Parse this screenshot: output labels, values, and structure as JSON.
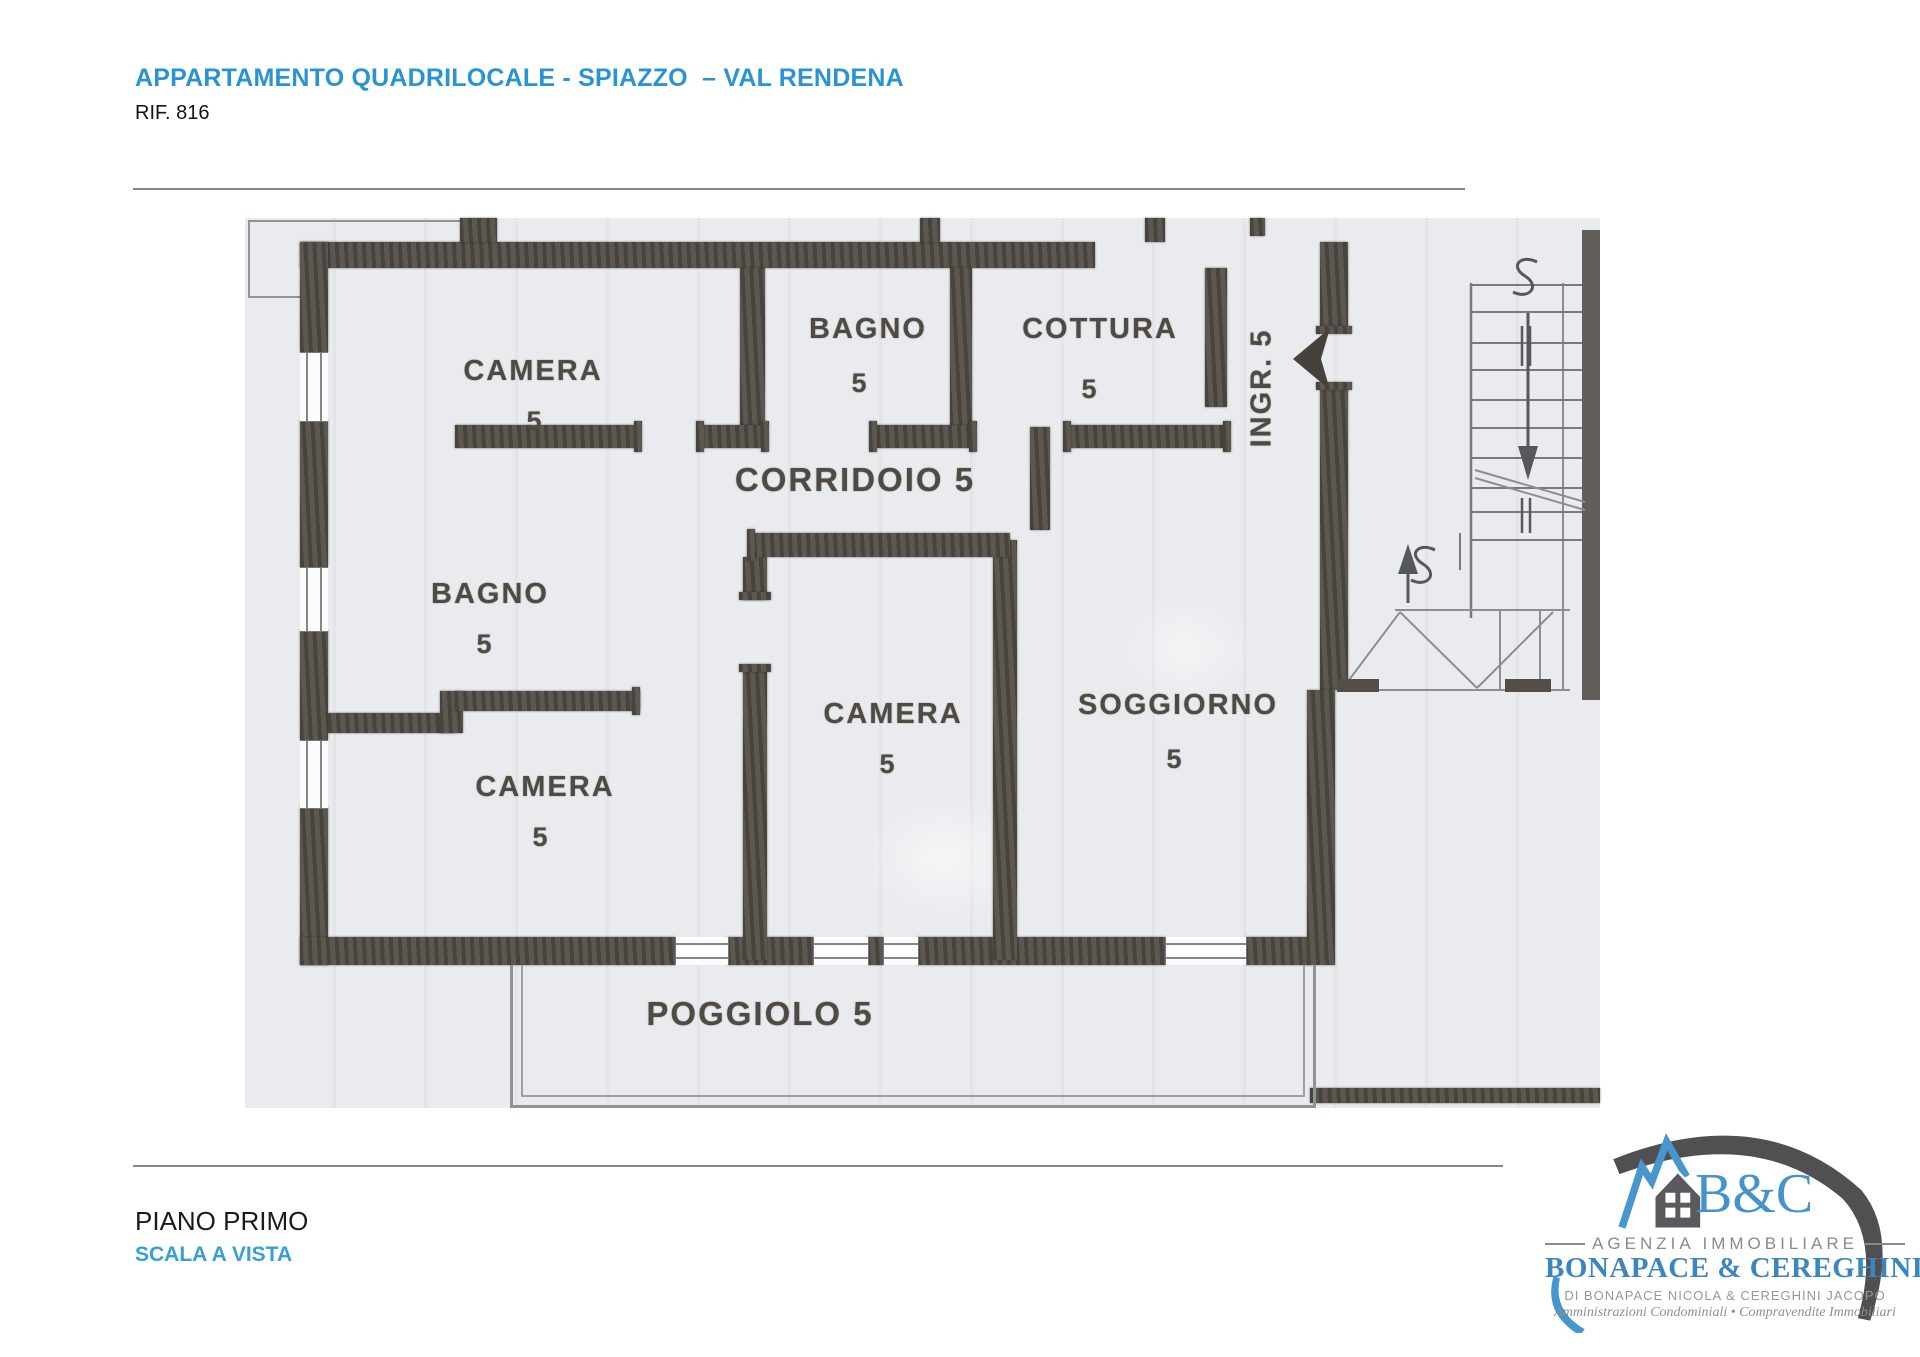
{
  "header": {
    "title": "APPARTAMENTO QUADRILOCALE - SPIAZZO  – VAL RENDENA",
    "reference": "RIF. 816"
  },
  "plan": {
    "rooms": [
      {
        "name": "CAMERA",
        "size": "5"
      },
      {
        "name": "BAGNO",
        "size": "5"
      },
      {
        "name": "COTTURA",
        "size": "5"
      },
      {
        "name": "BAGNO",
        "size": "5"
      },
      {
        "name": "CAMERA",
        "size": "5"
      },
      {
        "name": "CAMERA",
        "size": "5"
      },
      {
        "name": "SOGGIORNO",
        "size": "5"
      }
    ],
    "corridor": "CORRIDOIO 5",
    "entrance": "INGR. 5",
    "balcony": "POGGIOLO 5"
  },
  "footer": {
    "floor": "PIANO PRIMO",
    "stair_note": "SCALA A VISTA"
  },
  "logo": {
    "monogram": "B&C",
    "tagline": "AGENZIA IMMOBILIARE",
    "agency": "BONAPACE & CEREGHINI",
    "owners": "DI BONAPACE NICOLA & CEREGHINI JACOPO",
    "services": "Amministrazioni Condominiali • Compravendite Immobiliari"
  },
  "colors": {
    "accent_blue": "#2a93d2",
    "logo_blue": "#4796ce",
    "wall": "#534e47",
    "scan_bg": "#e9ebee"
  }
}
